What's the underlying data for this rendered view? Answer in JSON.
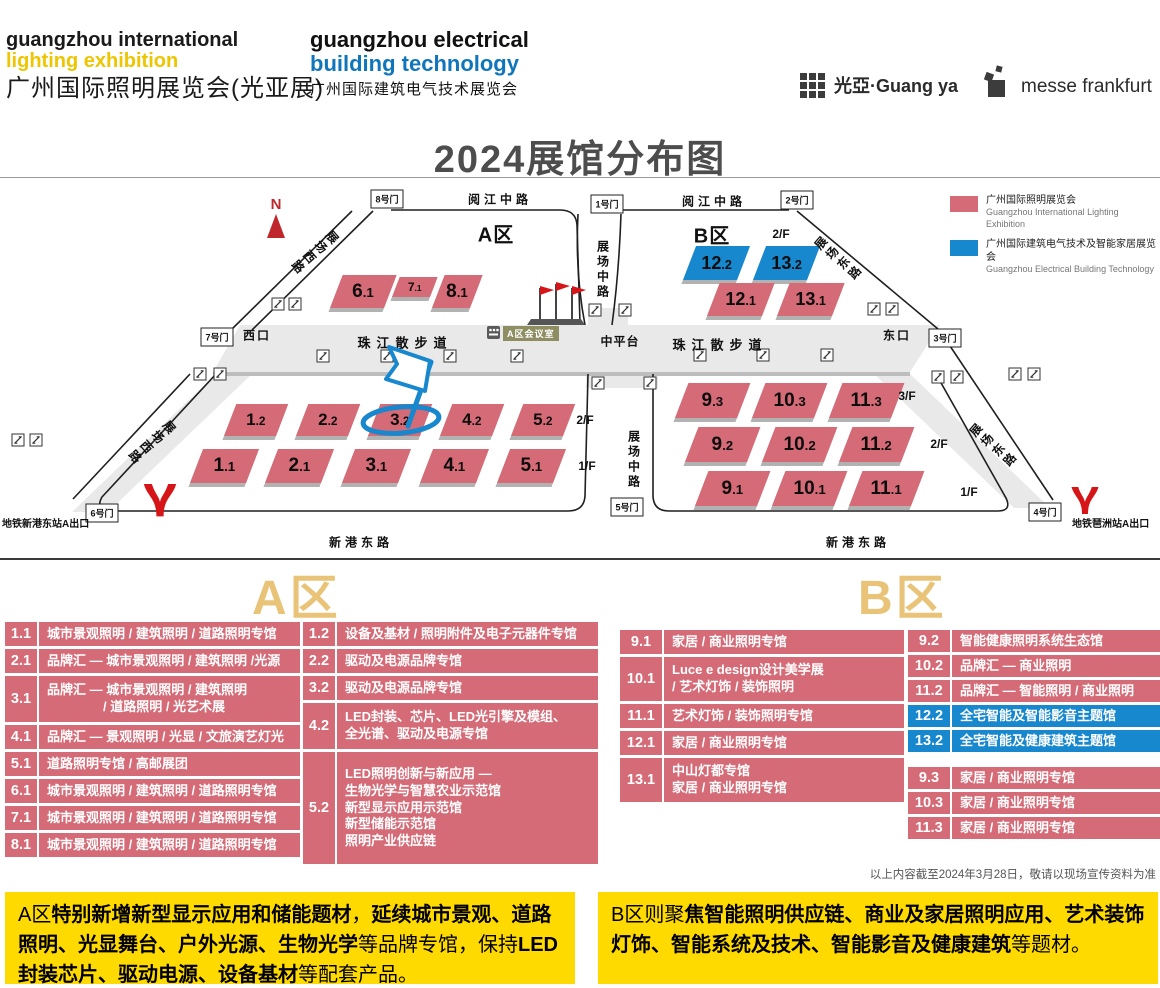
{
  "header": {
    "logo1": {
      "line1": "guangzhou international",
      "line2": "lighting exhibition",
      "line3": "广州国际照明展览会(光亚展)"
    },
    "logo2": {
      "line1": "guangzhou electrical",
      "line2": "building technology",
      "line3": "广州国际建筑电气技术展览会"
    },
    "guangya": "光亞·Guang ya",
    "messe": "messe frankfurt"
  },
  "title": "2024展馆分布图",
  "legend": {
    "items": [
      {
        "color": "#d46b77",
        "cn": "广州国际照明展览会",
        "en": "Guangzhou International Lighting Exhibition"
      },
      {
        "color": "#1787ce",
        "cn": "广州国际建筑电气技术及智能家居展览会",
        "en": "Guangzhou Electrical Building Technology"
      }
    ]
  },
  "map": {
    "compass": "N",
    "meeting_room": "A区会议室",
    "gates": [
      {
        "t": "8号门",
        "x": 387,
        "y": 21
      },
      {
        "t": "1号门",
        "x": 607,
        "y": 26
      },
      {
        "t": "2号门",
        "x": 797,
        "y": 22
      },
      {
        "t": "7号门",
        "x": 217,
        "y": 159
      },
      {
        "t": "3号门",
        "x": 945,
        "y": 160
      },
      {
        "t": "6号门",
        "x": 102,
        "y": 335
      },
      {
        "t": "5号门",
        "x": 627,
        "y": 329
      },
      {
        "t": "4号门",
        "x": 1045,
        "y": 334
      }
    ],
    "labels": [
      {
        "t": "阅江中路",
        "x": 500,
        "y": 21,
        "cls": "road"
      },
      {
        "t": "阅江中路",
        "x": 714,
        "y": 23,
        "cls": "road"
      },
      {
        "t": "新港东路",
        "x": 361,
        "y": 364,
        "cls": "road"
      },
      {
        "t": "新港东路",
        "x": 858,
        "y": 364,
        "cls": "road"
      },
      {
        "t": "珠江散步道",
        "x": 405,
        "y": 164,
        "cls": "prom"
      },
      {
        "t": "珠江散步道",
        "x": 720,
        "y": 166,
        "cls": "prom"
      },
      {
        "t": "中平台",
        "x": 620,
        "y": 163,
        "cls": "mid"
      },
      {
        "t": "西口",
        "x": 257,
        "y": 157,
        "cls": "entr"
      },
      {
        "t": "东口",
        "x": 897,
        "y": 157,
        "cls": "entr"
      },
      {
        "t": "A区",
        "x": 496,
        "y": 55,
        "cls": "zone"
      },
      {
        "t": "B区",
        "x": 712,
        "y": 56,
        "cls": "zone"
      },
      {
        "t": "2/F",
        "x": 781,
        "y": 56,
        "cls": "floor"
      },
      {
        "t": "2/F",
        "x": 585,
        "y": 242,
        "cls": "floor"
      },
      {
        "t": "1/F",
        "x": 587,
        "y": 288,
        "cls": "floor"
      },
      {
        "t": "3/F",
        "x": 907,
        "y": 218,
        "cls": "floor"
      },
      {
        "t": "2/F",
        "x": 939,
        "y": 266,
        "cls": "floor"
      },
      {
        "t": "1/F",
        "x": 969,
        "y": 314,
        "cls": "floor"
      }
    ],
    "vertical_roads": [
      {
        "t": "展场中路",
        "x": 603,
        "y": 91
      },
      {
        "t": "展场中路",
        "x": 634,
        "y": 281
      }
    ],
    "diagonal_roads": [
      {
        "t": "展场西路",
        "x": 315,
        "y": 74,
        "dir": "w"
      },
      {
        "t": "展场西路",
        "x": 152,
        "y": 264,
        "dir": "w"
      },
      {
        "t": "展场东路",
        "x": 838,
        "y": 80,
        "dir": "e"
      },
      {
        "t": "展场东路",
        "x": 993,
        "y": 267,
        "dir": "e"
      }
    ],
    "halls": [
      {
        "id": "6.1",
        "x": 330,
        "y": 97,
        "w": 54,
        "h": 33,
        "c": "r",
        "fs": 19
      },
      {
        "id": "7.1",
        "x": 392,
        "y": 99,
        "w": 38,
        "h": 20,
        "c": "r",
        "fs": 12
      },
      {
        "id": "8.1",
        "x": 432,
        "y": 97,
        "w": 38,
        "h": 33,
        "c": "r",
        "fs": 19
      },
      {
        "id": "1.2",
        "x": 224,
        "y": 226,
        "w": 52,
        "h": 32,
        "c": "r",
        "fs": 17
      },
      {
        "id": "2.2",
        "x": 296,
        "y": 226,
        "w": 52,
        "h": 32,
        "c": "r",
        "fs": 17
      },
      {
        "id": "3.2",
        "x": 368,
        "y": 226,
        "w": 52,
        "h": 32,
        "c": "r",
        "fs": 17
      },
      {
        "id": "4.2",
        "x": 440,
        "y": 226,
        "w": 52,
        "h": 32,
        "c": "r",
        "fs": 17
      },
      {
        "id": "5.2",
        "x": 511,
        "y": 226,
        "w": 52,
        "h": 32,
        "c": "r",
        "fs": 17
      },
      {
        "id": "1.1",
        "x": 190,
        "y": 271,
        "w": 56,
        "h": 34,
        "c": "r",
        "fs": 19
      },
      {
        "id": "2.1",
        "x": 265,
        "y": 271,
        "w": 56,
        "h": 34,
        "c": "r",
        "fs": 19
      },
      {
        "id": "3.1",
        "x": 342,
        "y": 271,
        "w": 56,
        "h": 34,
        "c": "r",
        "fs": 19
      },
      {
        "id": "4.1",
        "x": 420,
        "y": 271,
        "w": 56,
        "h": 34,
        "c": "r",
        "fs": 19
      },
      {
        "id": "5.1",
        "x": 497,
        "y": 271,
        "w": 56,
        "h": 34,
        "c": "r",
        "fs": 19
      },
      {
        "id": "12.2",
        "x": 683,
        "y": 68,
        "w": 54,
        "h": 34,
        "c": "b",
        "fs": 18
      },
      {
        "id": "13.2",
        "x": 753,
        "y": 68,
        "w": 54,
        "h": 34,
        "c": "b",
        "fs": 18
      },
      {
        "id": "12.1",
        "x": 707,
        "y": 105,
        "w": 55,
        "h": 33,
        "c": "r",
        "fs": 18
      },
      {
        "id": "13.1",
        "x": 777,
        "y": 105,
        "w": 55,
        "h": 33,
        "c": "r",
        "fs": 18
      },
      {
        "id": "9.3",
        "x": 675,
        "y": 205,
        "w": 62,
        "h": 35,
        "c": "r",
        "fs": 19
      },
      {
        "id": "10.3",
        "x": 752,
        "y": 205,
        "w": 62,
        "h": 35,
        "c": "r",
        "fs": 19
      },
      {
        "id": "11.3",
        "x": 829,
        "y": 205,
        "w": 62,
        "h": 35,
        "c": "r",
        "fs": 19
      },
      {
        "id": "9.2",
        "x": 685,
        "y": 249,
        "w": 62,
        "h": 35,
        "c": "r",
        "fs": 19
      },
      {
        "id": "10.2",
        "x": 762,
        "y": 249,
        "w": 62,
        "h": 35,
        "c": "r",
        "fs": 19
      },
      {
        "id": "11.2",
        "x": 839,
        "y": 249,
        "w": 62,
        "h": 35,
        "c": "r",
        "fs": 19
      },
      {
        "id": "9.1",
        "x": 695,
        "y": 293,
        "w": 62,
        "h": 35,
        "c": "r",
        "fs": 19
      },
      {
        "id": "10.1",
        "x": 772,
        "y": 293,
        "w": 62,
        "h": 35,
        "c": "r",
        "fs": 19
      },
      {
        "id": "11.1",
        "x": 849,
        "y": 293,
        "w": 62,
        "h": 35,
        "c": "r",
        "fs": 19
      }
    ],
    "escalators": [
      [
        278,
        126
      ],
      [
        295,
        126
      ],
      [
        200,
        196
      ],
      [
        220,
        196
      ],
      [
        323,
        178
      ],
      [
        387,
        178
      ],
      [
        450,
        178
      ],
      [
        517,
        178
      ],
      [
        595,
        132
      ],
      [
        625,
        132
      ],
      [
        700,
        177
      ],
      [
        763,
        177
      ],
      [
        827,
        177
      ],
      [
        874,
        131
      ],
      [
        892,
        131
      ],
      [
        598,
        205
      ],
      [
        650,
        205
      ],
      [
        938,
        199
      ],
      [
        957,
        199
      ],
      [
        1015,
        196
      ],
      [
        1034,
        196
      ],
      [
        18,
        262
      ],
      [
        36,
        262
      ]
    ],
    "metro": [
      {
        "t": "地铁新港东站A出口",
        "tx": 2,
        "ty": 337
      },
      {
        "t": "地铁琶洲站A出口",
        "tx": 1072,
        "ty": 337
      }
    ]
  },
  "sections": {
    "a": "A区",
    "b": "B区"
  },
  "tables": {
    "a_left": [
      {
        "no": "1.1",
        "h": 24,
        "lines": [
          "城市景观照明 / 建筑照明 / 道路照明专馆"
        ]
      },
      {
        "no": "2.1",
        "h": 24,
        "lines": [
          "品牌汇 — 城市景观照明 / 建筑照明 /光源"
        ]
      },
      {
        "no": "3.1",
        "h": 46,
        "lines": [
          "品牌汇 — 城市景观照明 / 建筑照明",
          {
            "t": "/ 道路照明 / 光艺术展",
            "pad": 56
          }
        ]
      },
      {
        "no": "4.1",
        "h": 24,
        "lines": [
          "品牌汇 — 景观照明 / 光显 / 文旅演艺灯光"
        ]
      },
      {
        "no": "5.1",
        "h": 24,
        "lines": [
          "道路照明专馆 / 高邮展团"
        ]
      },
      {
        "no": "6.1",
        "h": 24,
        "lines": [
          "城市景观照明 / 建筑照明 / 道路照明专馆"
        ]
      },
      {
        "no": "7.1",
        "h": 24,
        "lines": [
          "城市景观照明 / 建筑照明 / 道路照明专馆"
        ]
      },
      {
        "no": "8.1",
        "h": 24,
        "lines": [
          "城市景观照明 / 建筑照明 / 道路照明专馆"
        ]
      }
    ],
    "a_right": [
      {
        "no": "1.2",
        "h": 24,
        "lines": [
          "设备及基材 / 照明附件及电子元器件专馆"
        ]
      },
      {
        "no": "2.2",
        "h": 24,
        "lines": [
          "驱动及电源品牌专馆"
        ]
      },
      {
        "no": "3.2",
        "h": 24,
        "lines": [
          "驱动及电源品牌专馆"
        ]
      },
      {
        "no": "4.2",
        "h": 46,
        "lines": [
          "LED封装、芯片、LED光引擎及模组、",
          "全光谱、驱动及电源专馆"
        ]
      },
      {
        "no": "5.2",
        "h": 112,
        "lines": [
          "LED照明创新与新应用 —",
          "生物光学与智慧农业示范馆",
          "新型显示应用示范馆",
          "新型储能示范馆",
          "照明产业供应链"
        ]
      }
    ],
    "b_left": [
      {
        "no": "9.1",
        "h": 24,
        "lines": [
          "家居 / 商业照明专馆"
        ]
      },
      {
        "no": "10.1",
        "h": 44,
        "lines": [
          "Luce e design设计美学展",
          "/ 艺术灯饰 / 装饰照明"
        ]
      },
      {
        "no": "11.1",
        "h": 24,
        "lines": [
          "艺术灯饰 / 装饰照明专馆"
        ]
      },
      {
        "no": "12.1",
        "h": 24,
        "lines": [
          "家居 / 商业照明专馆"
        ]
      },
      {
        "no": "13.1",
        "h": 44,
        "lines": [
          "中山灯都专馆",
          "家居 / 商业照明专馆"
        ]
      }
    ],
    "b_right": [
      {
        "no": "9.2",
        "h": 22,
        "lines": [
          "智能健康照明系统生态馆"
        ]
      },
      {
        "no": "10.2",
        "h": 22,
        "lines": [
          "品牌汇 — 商业照明"
        ]
      },
      {
        "no": "11.2",
        "h": 22,
        "lines": [
          "品牌汇 — 智能照明 / 商业照明"
        ]
      },
      {
        "no": "12.2",
        "h": 22,
        "blue": true,
        "lines": [
          "全宅智能及智能影音主题馆"
        ]
      },
      {
        "no": "13.2",
        "h": 22,
        "blue": true,
        "lines": [
          "全宅智能及健康建筑主题馆"
        ]
      },
      {
        "gap": 12
      },
      {
        "no": "9.3",
        "h": 22,
        "lines": [
          "家居 / 商业照明专馆"
        ]
      },
      {
        "no": "10.3",
        "h": 22,
        "lines": [
          "家居 / 商业照明专馆"
        ]
      },
      {
        "no": "11.3",
        "h": 22,
        "lines": [
          "家居 / 商业照明专馆"
        ]
      }
    ]
  },
  "footnote": "以上内容截至2024年3月28日，敬请以现场宣传资料为准",
  "notes": {
    "a": [
      {
        "t": "A区",
        "b": false
      },
      {
        "t": "特别新增新型显示应用和储能题材",
        "b": true
      },
      {
        "t": "，",
        "b": false
      },
      {
        "t": "延续城市景观、道路照明、光显舞台、户外光源、生物光学",
        "b": true
      },
      {
        "t": "等品牌专馆，保持",
        "b": false
      },
      {
        "t": "LED封装芯片、驱动电源、设备基材",
        "b": true
      },
      {
        "t": "等配套产品。",
        "b": false
      }
    ],
    "b": [
      {
        "t": "B区则聚",
        "b": false
      },
      {
        "t": "焦智能照明供应链、商业及家居照明应用、艺术装饰灯饰、智能系统及技术、智能影音及健康建筑",
        "b": true
      },
      {
        "t": "等题材。",
        "b": false
      }
    ]
  }
}
